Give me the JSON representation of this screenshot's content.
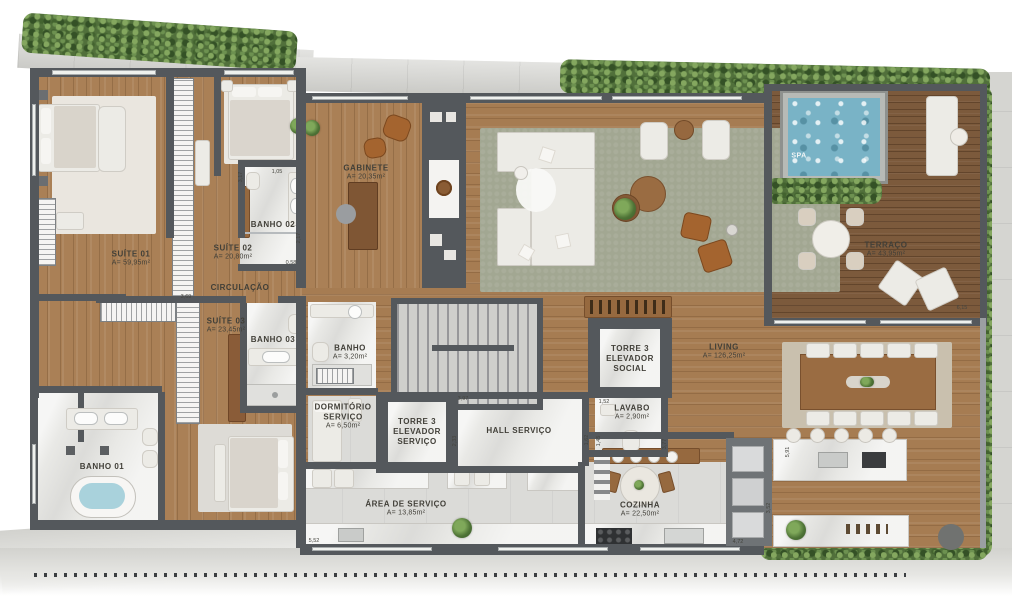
{
  "plan_title": "Apartment floor plan",
  "rooms": [
    {
      "name": "SUÍTE 01",
      "area": "A= 59,95m²"
    },
    {
      "name": "SUÍTE 02",
      "area": "A= 20,80m²"
    },
    {
      "name": "BANHO 02",
      "area": ""
    },
    {
      "name": "CIRCULAÇÃO",
      "area": ""
    },
    {
      "name": "GABINETE",
      "area": "A= 20,35m²"
    },
    {
      "name": "SPA",
      "area": ""
    },
    {
      "name": "TERRAÇO",
      "area": "A= 43,95m²"
    },
    {
      "name": "LIVING",
      "area": "A= 126,25m²"
    },
    {
      "name": "SUÍTE 03",
      "area": "A= 23,45m²"
    },
    {
      "name": "BANHO 03",
      "area": ""
    },
    {
      "name": "BANHO",
      "area": "A= 3,20m²"
    },
    {
      "name": "DORMITÓRIO SERVIÇO",
      "area": "A= 6,50m²"
    },
    {
      "name": "TORRE 3 ELEVADOR SERVIÇO",
      "area": ""
    },
    {
      "name": "HALL SERVIÇO",
      "area": ""
    },
    {
      "name": "TORRE 3 ELEVADOR SOCIAL",
      "area": ""
    },
    {
      "name": "LAVABO",
      "area": "A= 2,90m²"
    },
    {
      "name": "BANHO 01",
      "area": ""
    },
    {
      "name": "ÁREA DE SERVIÇO",
      "area": "A= 13,85m²"
    },
    {
      "name": "COZINHA",
      "area": "A= 22,50m²"
    }
  ],
  "dimensions": [
    "3,69",
    "1,05",
    "3,17",
    "2,17",
    "0,58",
    "3,97",
    "2,33",
    "1,52",
    "1,45",
    "3,77",
    "5,91",
    "4,72",
    "3,52",
    "1,62",
    "5,52",
    "6,15"
  ],
  "colors": {
    "wall": "#54585c",
    "wood_floor": "#aa8056",
    "deck": "#7c5a3c",
    "marble": "#e9e9e6",
    "rug_living": "#a2a792",
    "rug_dining": "#c9c0ae",
    "hedge": "#51703b",
    "pool_water": "#79b3c6",
    "concrete": "#d5d5d1"
  }
}
